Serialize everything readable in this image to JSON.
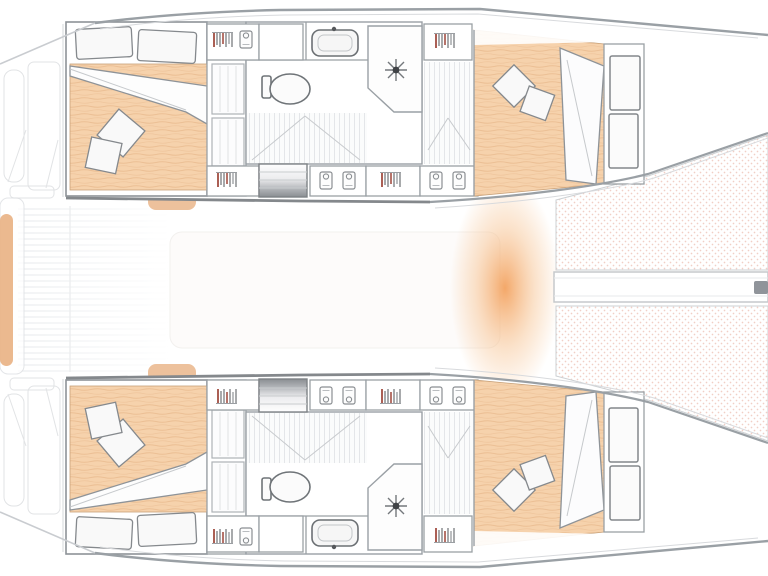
{
  "diagram": {
    "type": "catamaran-floorplan-top-view",
    "hull_count": 2,
    "visible_features": {
      "hulls": [
        "port-hull",
        "starboard-hull"
      ],
      "per_hull": [
        "aft-double-bed",
        "pillows",
        "throw-cushions",
        "wardrobe-lockers",
        "shelf-column",
        "companionway-stairs",
        "sink",
        "toilet",
        "shower",
        "forward-double-bed",
        "bow-shelves"
      ],
      "shared": [
        "cockpit-deck",
        "aft-crossbeam",
        "foredeck-glow",
        "forward-crossbeam-bowsprit",
        "trampoline-net"
      ]
    },
    "colors": {
      "hull_outline": "#9aa0a5",
      "hull_outline_dark": "#84888c",
      "wall": "#9aa0a5",
      "mattress": "#f6d2ac",
      "mattress_grain": "#e9ba8e",
      "trampoline_dot": "#f1cfc6",
      "accent_red": "#96372a",
      "stairs_dark": "#8a8e92",
      "deck_glow": "#f3a361",
      "tan": "#e9b183",
      "plank": "#e4e6e9"
    }
  }
}
